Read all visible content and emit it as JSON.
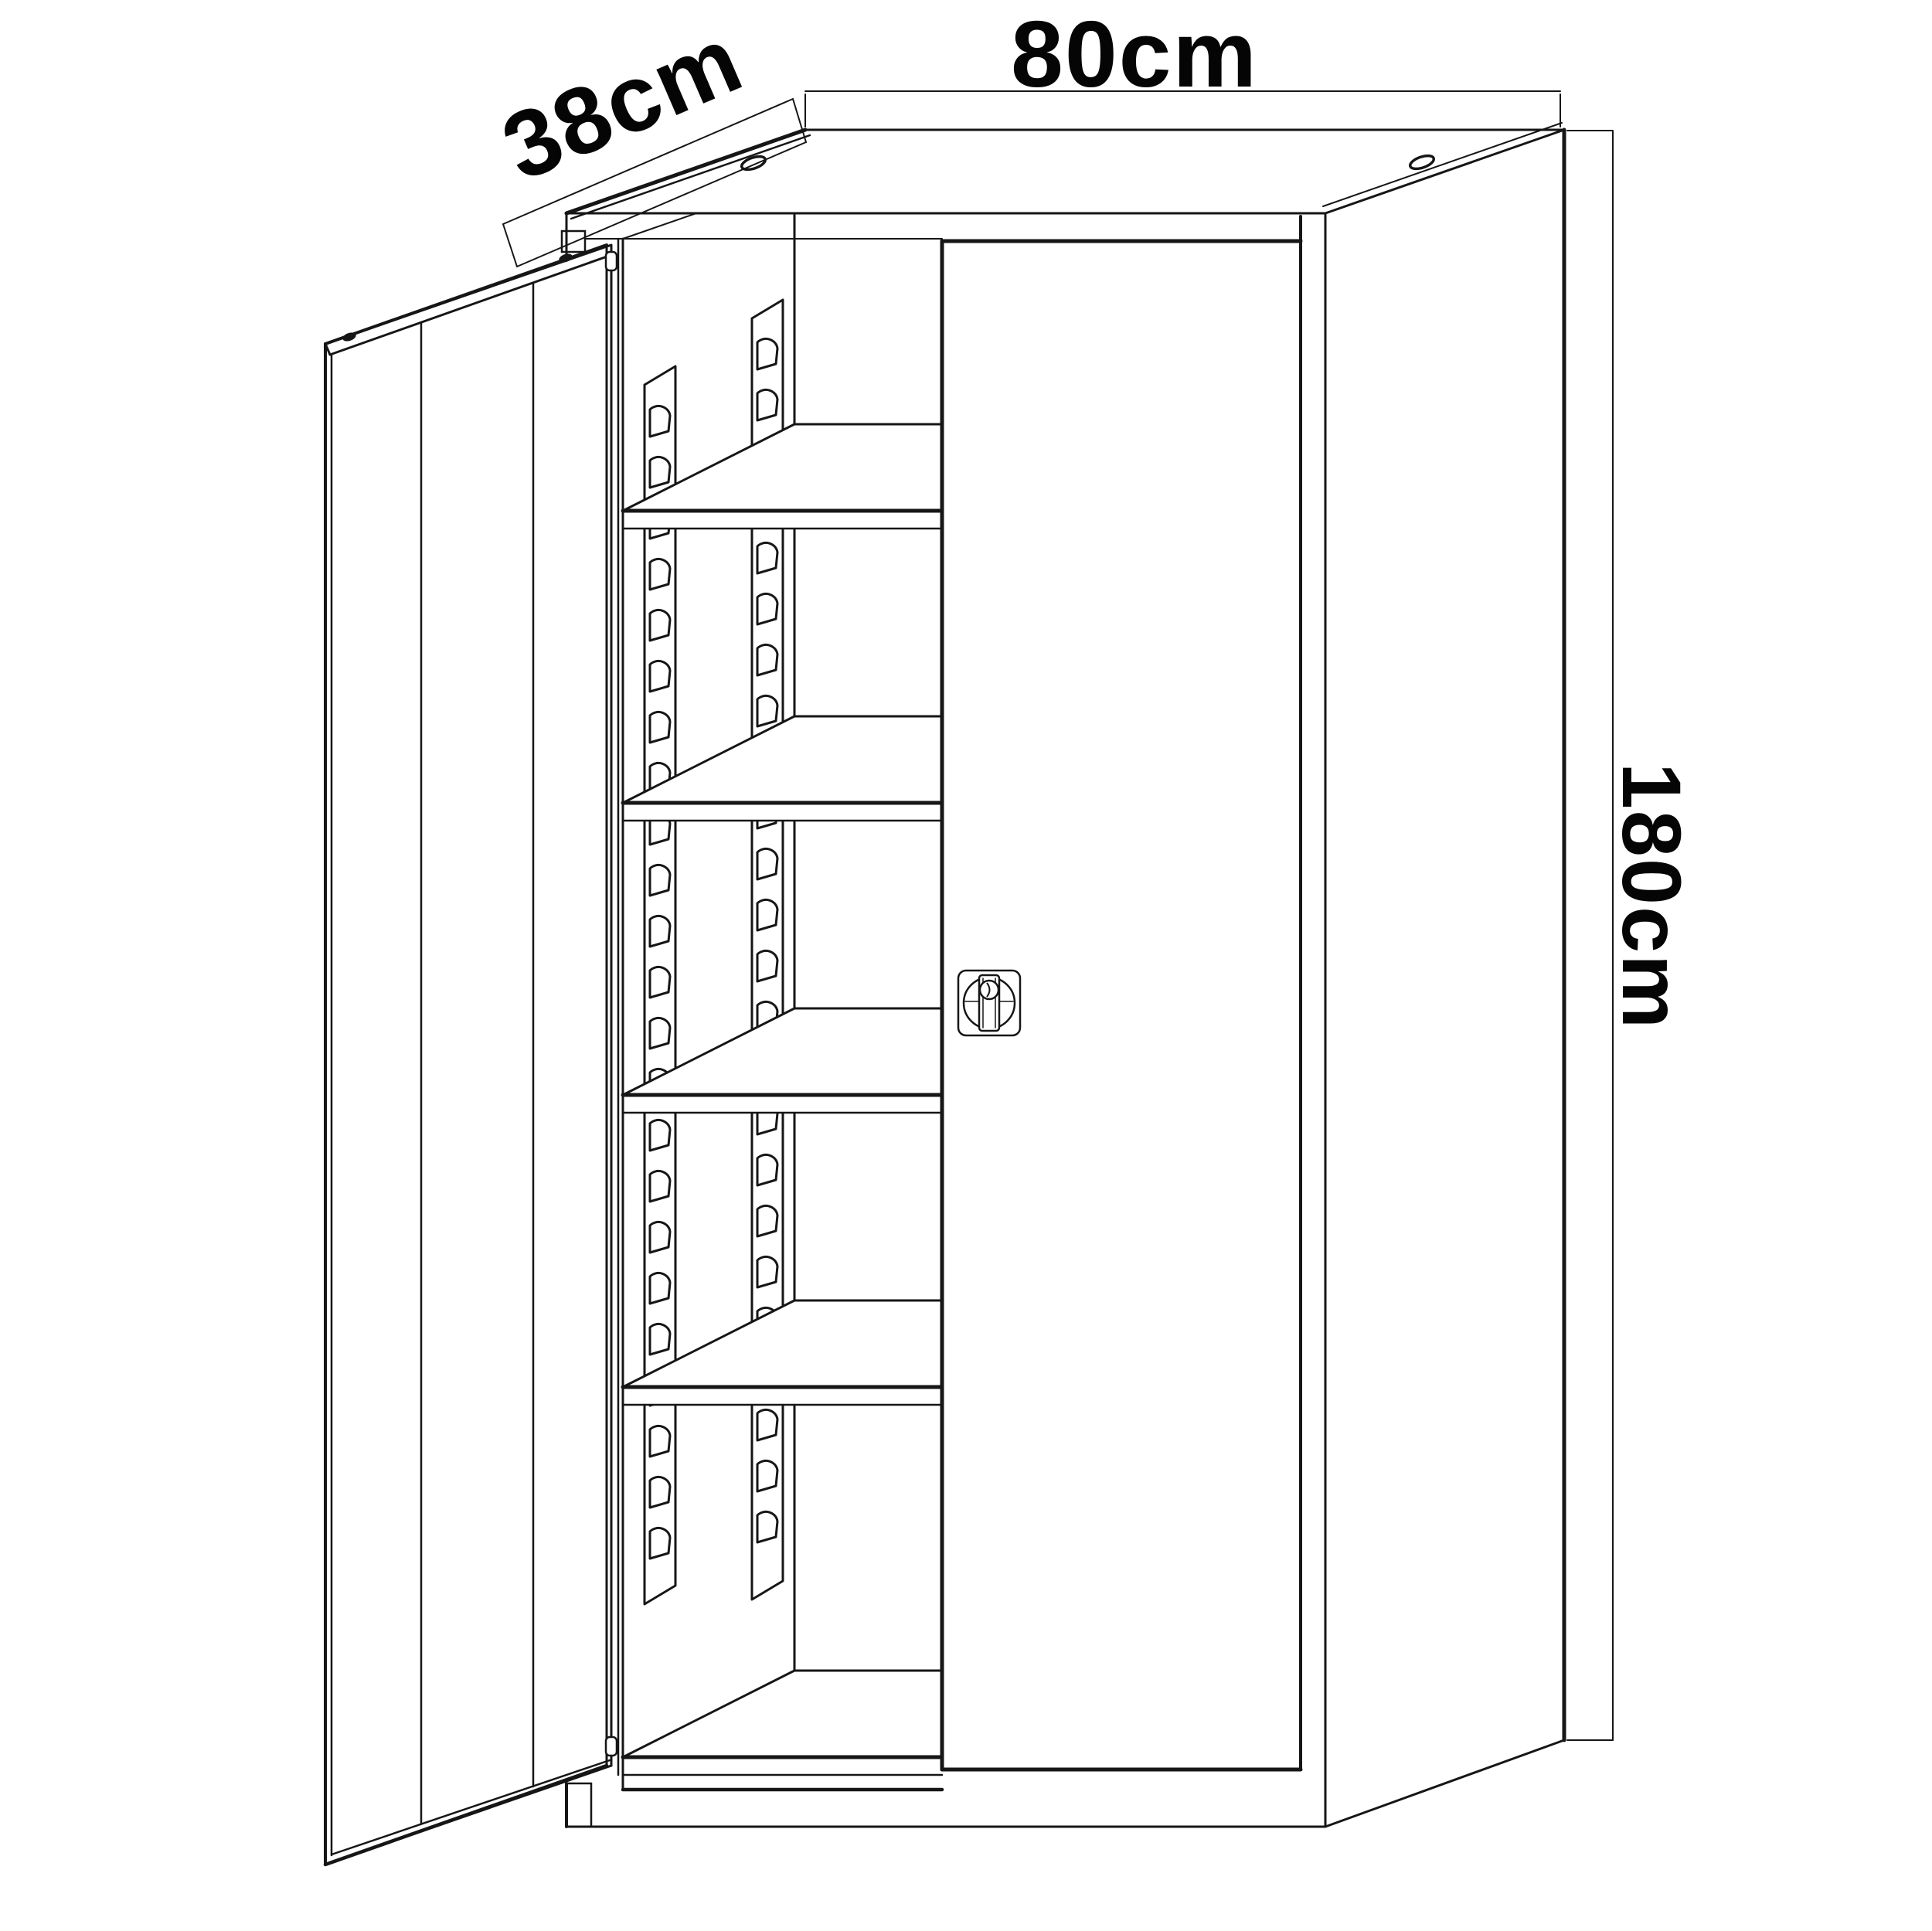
{
  "drawing": {
    "type": "furniture-technical-line-drawing",
    "background_color": "#ffffff",
    "line_color": "#161616",
    "dimensions": {
      "width": {
        "label": "80cm"
      },
      "depth": {
        "label": "38cm"
      },
      "height": {
        "label": "180cm"
      }
    },
    "cabinet": {
      "shelf_count": 4,
      "door_open_side": "left",
      "door_closed_side": "right",
      "support_rail_count": 2,
      "rail_hole_shape": "arched-slot",
      "top_screw_hole_count": 2,
      "lock": {
        "style": "rotary-bar-cam-lock"
      }
    }
  }
}
